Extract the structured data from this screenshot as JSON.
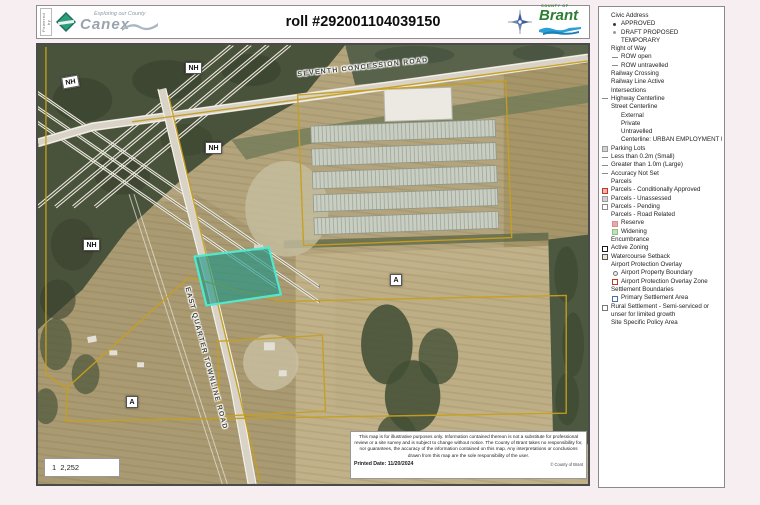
{
  "header": {
    "powered_by": "Powered by",
    "logo_tagline": "Exploring our County",
    "logo_word": "Canex",
    "title": "roll #292001104039150",
    "county_of": "COUNTY OF",
    "county_name": "Brant"
  },
  "map": {
    "road_top": "SEVENTH CONCESSION ROAD",
    "road_main": "EAST QUARTER TOWNLINE ROAD",
    "zone_nh": "NH",
    "zone_a": "A",
    "scale_text": "1  2,252",
    "highlight_color": "#2a9d92",
    "parcel_line_color": "#c79f1f",
    "disclaimer": "This map is for illustrative purposes only. Information contained thereon is not a substitute for professional review or a site survey and is subject to change without notice. The County of Brant takes no responsibility for, nor guarantees, the accuracy of the information contained on this map. Any interpretations or conclusions drawn from this map are the sole responsibility of the user.",
    "printed_date_label": "Printed Date:  11/20/2024",
    "copyright": "© County of Brant"
  },
  "legend": {
    "items": [
      {
        "label": "Civic Address"
      },
      {
        "label": "APPROVED"
      },
      {
        "label": "DRAFT PROPOSED"
      },
      {
        "label": "TEMPORARY"
      },
      {
        "label": "Right of Way"
      },
      {
        "label": "ROW open"
      },
      {
        "label": "ROW untravelled"
      },
      {
        "label": "Railway  Crossing"
      },
      {
        "label": "Railway Line Active"
      },
      {
        "label": "Intersections"
      },
      {
        "label": "Highway Centerline"
      },
      {
        "label": "Street Centerline"
      },
      {
        "label": "External"
      },
      {
        "label": "Private"
      },
      {
        "label": "Untravelled"
      },
      {
        "label": "Centerline: URBAN EMPLOYMENT LOC"
      },
      {
        "label": "Parking Lots"
      },
      {
        "label": "Less than 0.2m (Small)"
      },
      {
        "label": "Greater than 1.0m (Large)"
      },
      {
        "label": "Accuracy Not Set"
      },
      {
        "label": "Parcels"
      },
      {
        "label": "Parcels - Conditionally Approved"
      },
      {
        "label": "Parcels - Unassessed"
      },
      {
        "label": "Parcels - Pending"
      },
      {
        "label": "Parcels - Road Related"
      },
      {
        "label": "Reserve"
      },
      {
        "label": "Widening"
      },
      {
        "label": "Encumbrance"
      },
      {
        "label": "Active Zoning"
      },
      {
        "label": "Watercourse Setback"
      },
      {
        "label": "Airport Protection Overlay"
      },
      {
        "label": "Airport Property Boundary"
      },
      {
        "label": "Airport Protection Overlay Zone"
      },
      {
        "label": "Settlement Boundaries"
      },
      {
        "label": "Primary Settlement Area"
      },
      {
        "label": "Rural Settlement - Semi-serviced or unser for limited growth"
      },
      {
        "label": "Site Specific Policy Area"
      }
    ]
  }
}
